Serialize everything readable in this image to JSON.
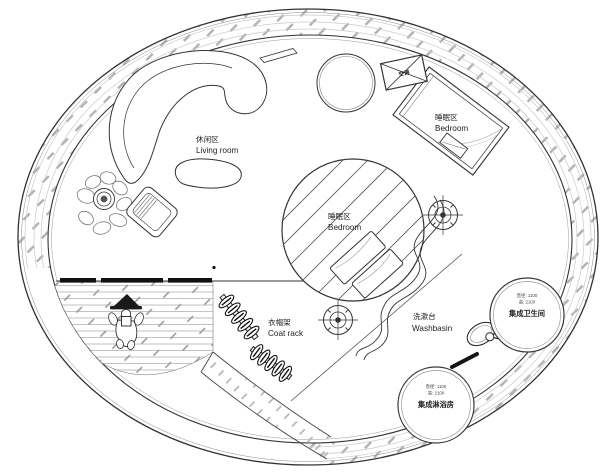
{
  "zones": {
    "living": {
      "zh": "休闲区",
      "en": "Living room"
    },
    "bedroom_platform": {
      "zh": "睡眠区",
      "en": "Bedroom"
    },
    "bedroom_upper": {
      "zh": "睡眠区",
      "en": "Bedroom"
    },
    "coat_rack": {
      "zh": "衣帽架",
      "en": "Coat rack"
    },
    "washbasin": {
      "zh": "洗漱台",
      "en": "Washbasin"
    }
  },
  "pods": {
    "bathroom": {
      "name": "集成卫生间",
      "dim_line1": "直径: 1100",
      "dim_line2": "高: 2100"
    },
    "shower": {
      "name": "集成淋浴房",
      "dim_line1": "直径: 1100",
      "dim_line2": "高: 2100"
    }
  },
  "equipment": {
    "ac_label": "空调"
  },
  "symbols": {
    "light_fixture": "crosshair-target-icon",
    "ac_unit": "crossed-box-icon",
    "person": "person-figure",
    "plant": "potted-plant"
  },
  "colors": {
    "line": "#3a3a3a",
    "hatch": "#b4b4b4",
    "deck_line": "#8f8f8f",
    "black_fill": "#111111"
  }
}
